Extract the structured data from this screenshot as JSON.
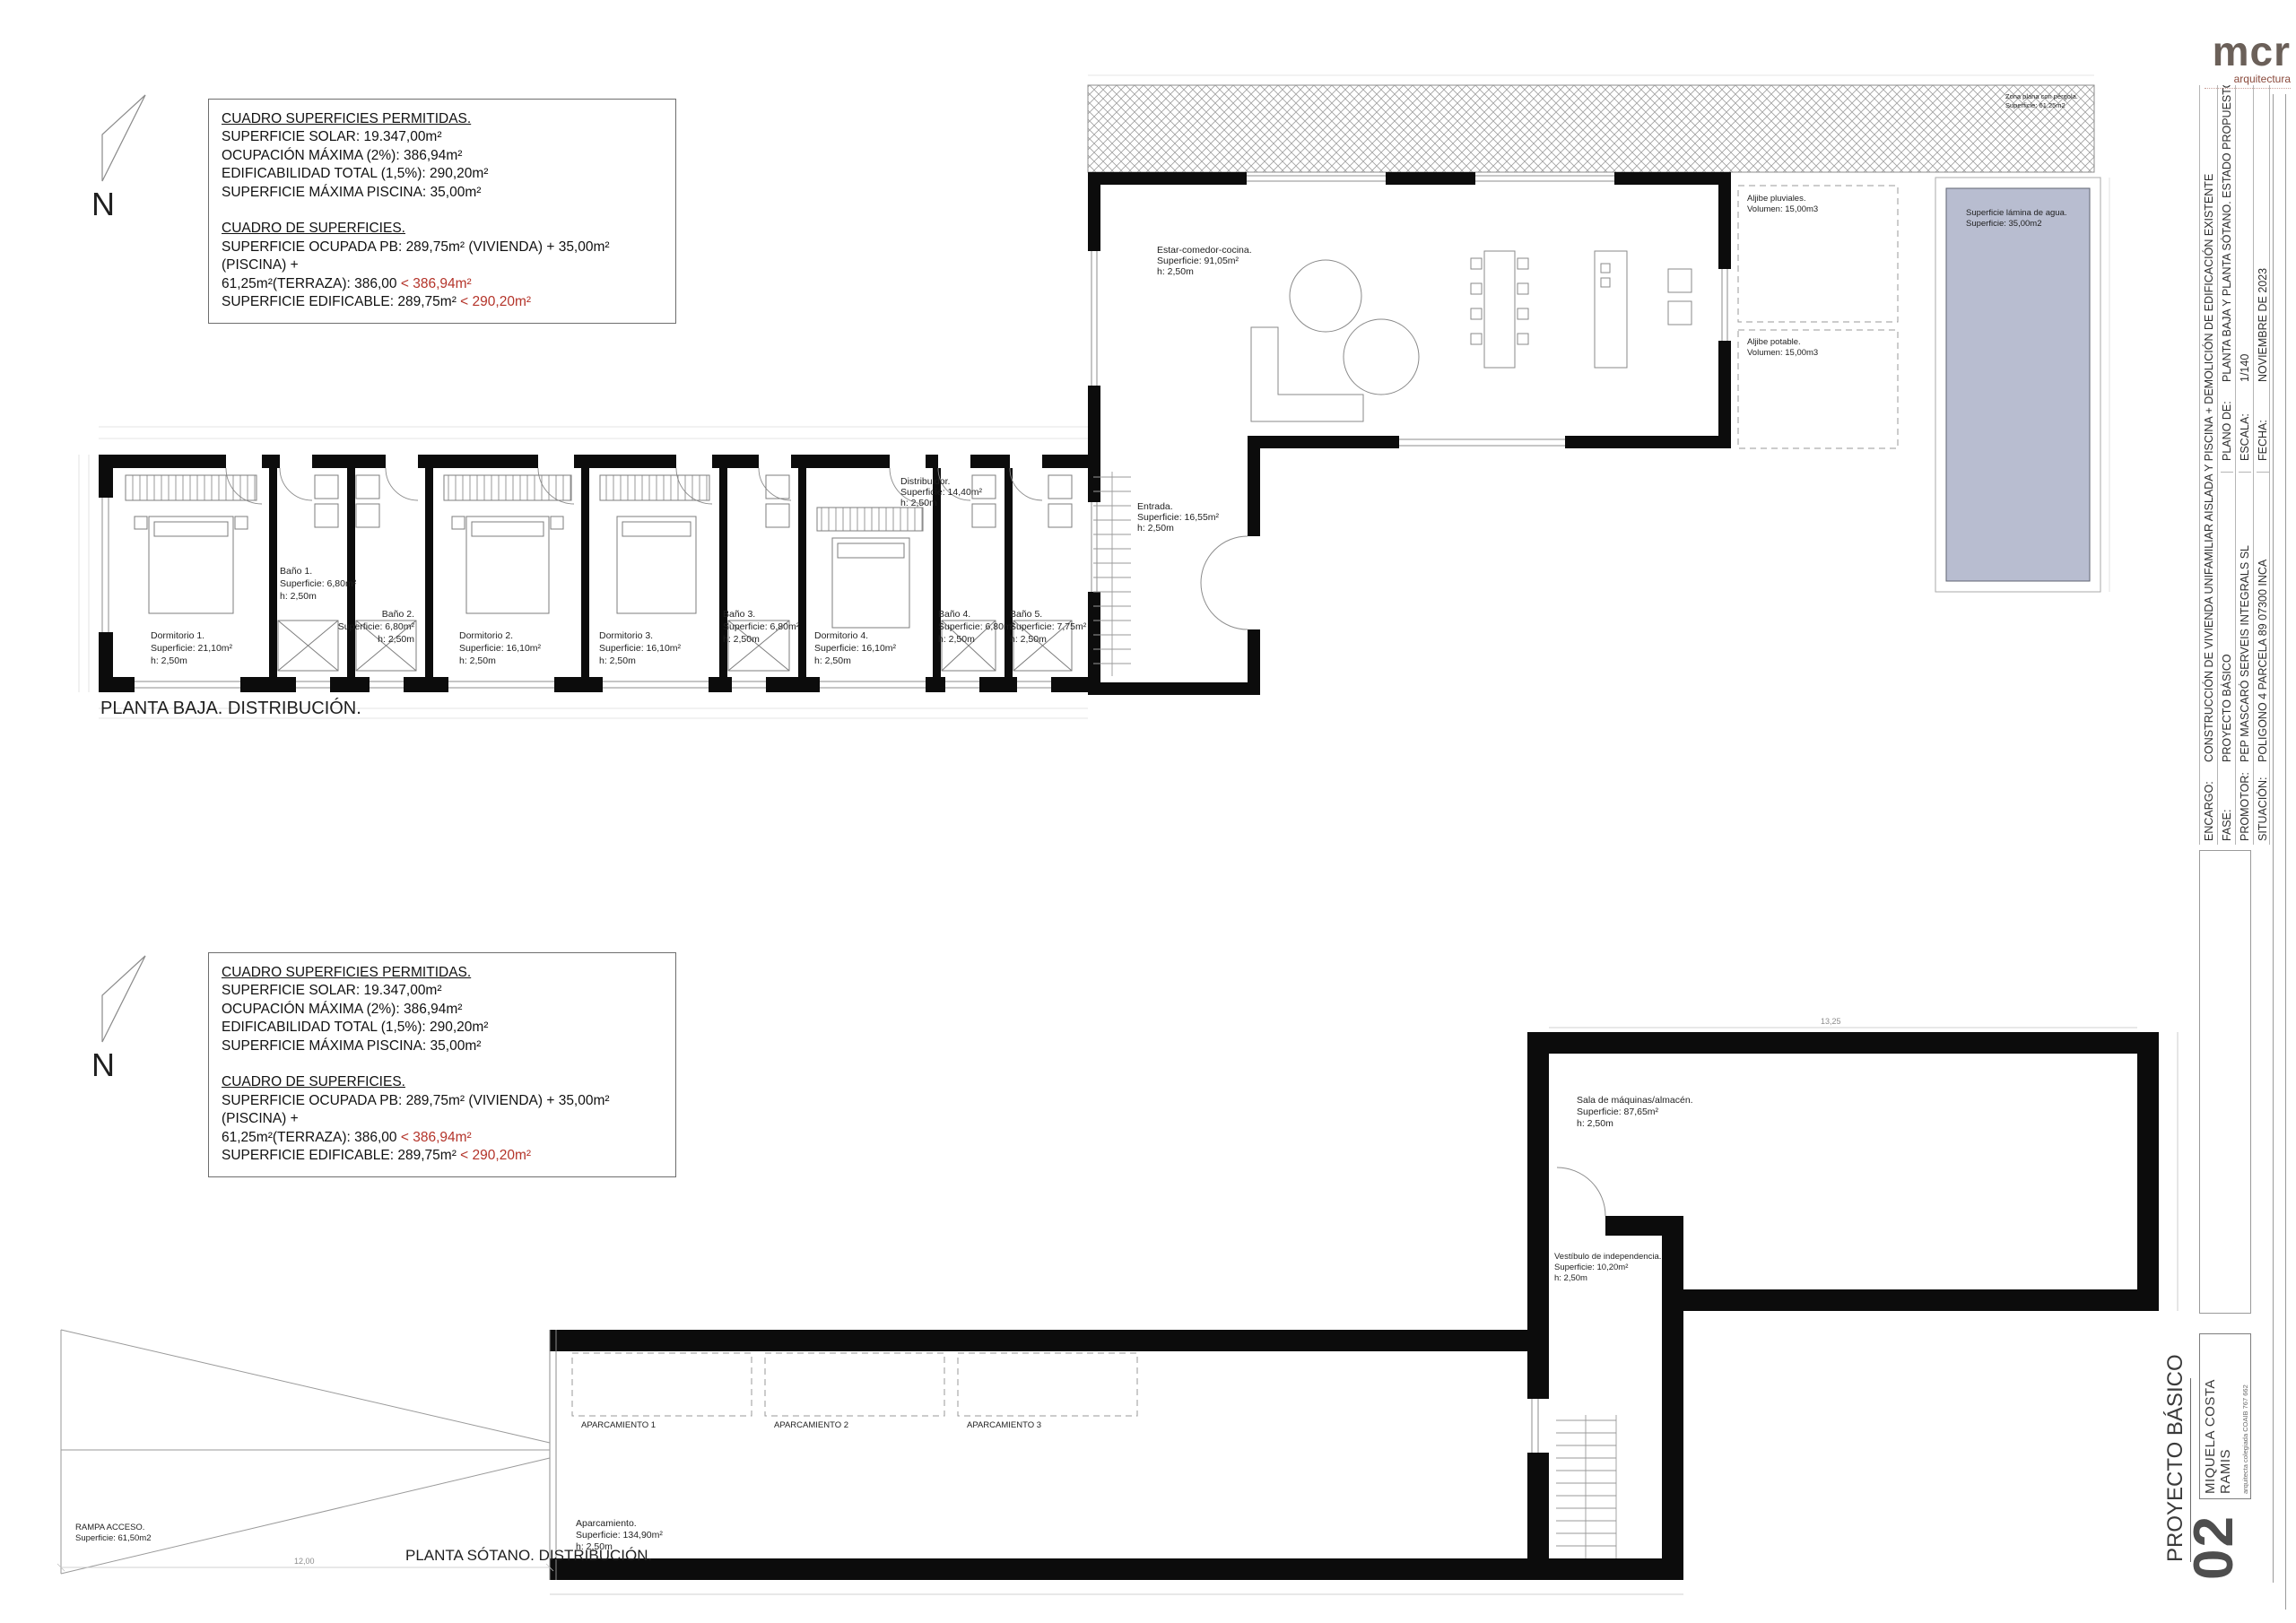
{
  "logo": {
    "mark": "mcr",
    "subtitle": "arquitectura"
  },
  "north": {
    "label": "N"
  },
  "cuadro": {
    "title1": "CUADRO SUPERFICIES PERMITIDAS.",
    "l1": "SUPERFICIE SOLAR: 19.347,00m²",
    "l2": "OCUPACIÓN MÁXIMA (2%): 386,94m²",
    "l3": "EDIFICABILIDAD TOTAL (1,5%): 290,20m²",
    "l4": "SUPERFICIE MÁXIMA PISCINA: 35,00m²",
    "title2": "CUADRO DE SUPERFICIES.",
    "l5": "SUPERFICIE OCUPADA PB: 289,75m² (VIVIENDA) + 35,00m² (PISCINA) +",
    "l6a": "61,25m²(TERRAZA): 386,00 ",
    "l6b": "< 386,94m²",
    "l7a": "SUPERFICIE EDIFICABLE: 289,75m² ",
    "l7b": "< 290,20m²"
  },
  "titleblock": {
    "encargo_label": "ENCARGO:",
    "encargo": "CONSTRUCCIÓN DE VIVIENDA UNIFAMILIAR AISLADA Y PISCINA + DEMOLICIÓN DE EDIFICACIÓN EXISTENTE",
    "fase_label": "FASE:",
    "fase": "PROYECTO BÁSICO",
    "promotor_label": "PROMOTOR:",
    "promotor": "PEP MASCARÓ SERVEIS INTEGRALS SL",
    "situacion_label": "SITUACIÓN:",
    "situacion": "POLIGONO 4 PARCELA 89 07300 INCA",
    "plano_label": "PLANO DE:",
    "plano": "PLANTA BAJA Y PLANTA SÓTANO. ESTADO PROPUESTO.",
    "escala_label": "ESCALA:",
    "escala": "1/140",
    "fecha_label": "FECHA:",
    "fecha": "NOVIEMBRE DE 2023"
  },
  "sheet": {
    "phase": "PROYECTO BÁSICO",
    "number": "02",
    "architect": "MIQUELA COSTA RAMIS",
    "architect_sub": "arquitecta colegiada COAIB 767 662"
  },
  "plan_baja": {
    "caption": "PLANTA BAJA. DISTRIBUCIÓN.",
    "rooms": {
      "estar": {
        "n": "Estar-comedor-cocina.",
        "a": "Superficie: 91,05m²",
        "h": "h: 2,50m"
      },
      "distribuidor": {
        "n": "Distribuidor.",
        "a": "Superficie: 14,40m²",
        "h": "h: 2,50m"
      },
      "entrada": {
        "n": "Entrada.",
        "a": "Superficie: 16,55m²",
        "h": "h: 2,50m"
      },
      "dorm1": {
        "n": "Dormitorio 1.",
        "a": "Superficie: 21,10m²",
        "h": "h: 2,50m"
      },
      "dorm2": {
        "n": "Dormitorio 2.",
        "a": "Superficie: 16,10m²",
        "h": "h: 2,50m"
      },
      "dorm3": {
        "n": "Dormitorio 3.",
        "a": "Superficie: 16,10m²",
        "h": "h: 2,50m"
      },
      "dorm4": {
        "n": "Dormitorio 4.",
        "a": "Superficie: 16,10m²",
        "h": "h: 2,50m"
      },
      "bano1": {
        "n": "Baño 1.",
        "a": "Superficie: 6,80m²",
        "h": "h: 2,50m"
      },
      "bano2": {
        "n": "Baño 2.",
        "a": "Superficie: 6,80m²",
        "h": "h: 2,50m"
      },
      "bano3": {
        "n": "Baño 3.",
        "a": "Superficie: 6,80m²",
        "h": "h: 2,50m"
      },
      "bano4": {
        "n": "Baño 4.",
        "a": "Superficie: 6,80m²",
        "h": "h: 2,50m"
      },
      "bano5": {
        "n": "Baño 5.",
        "a": "Superficie: 7,75m²",
        "h": "h: 2,50m"
      },
      "aljibe1": {
        "n": "Aljibe pluviales.",
        "a": "Volumen: 15,00m3"
      },
      "aljibe2": {
        "n": "Aljibe potable.",
        "a": "Volumen: 15,00m3"
      },
      "pool": {
        "n": "Superficie lámina de agua.",
        "a": "Superficie: 35,00m2"
      },
      "terraza": {
        "n": "Zona plana con pérgola.",
        "a": "Superficie: 61,25m2"
      }
    }
  },
  "plan_sotano": {
    "caption": "PLANTA SÓTANO. DISTRIBUCIÓN.",
    "rooms": {
      "sala": {
        "n": "Sala de máquinas/almacén.",
        "a": "Superficie: 87,65m²",
        "h": "h: 2,50m"
      },
      "vestibulo": {
        "n": "Vestíbulo de independencia.",
        "a": "Superficie: 10,20m²",
        "h": "h: 2,50m"
      },
      "aparcamiento": {
        "n": "Aparcamiento.",
        "a": "Superficie: 134,90m²",
        "h": "h: 2,50m"
      },
      "ap1": "APARCAMIENTO 1",
      "ap2": "APARCAMIENTO 2",
      "ap3": "APARCAMIENTO 3",
      "rampa": {
        "n": "RAMPA ACCESO.",
        "a": "Superficie: 61,50m2"
      }
    },
    "dims": {
      "ramp": "12,00",
      "sala_top": "13,25"
    }
  }
}
